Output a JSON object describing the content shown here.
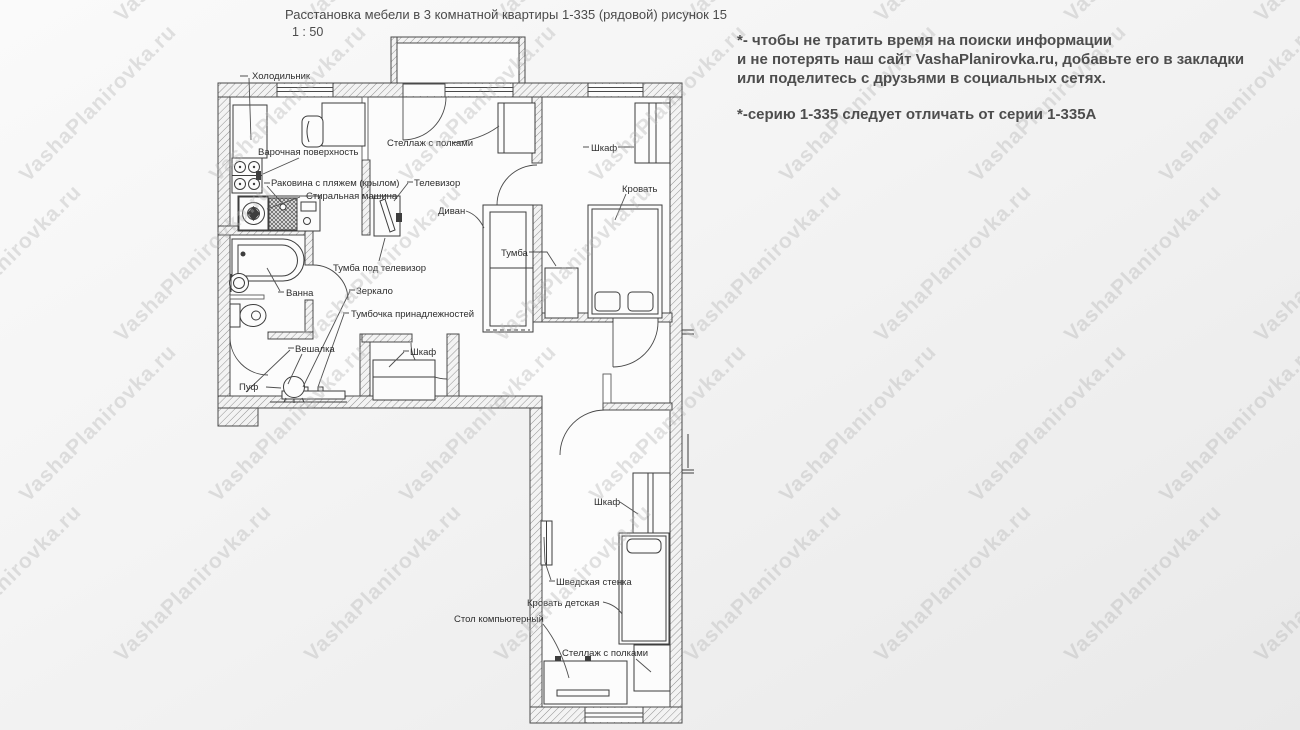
{
  "header": {
    "title": "Расстановка мебели в 3 комнатной квартиры 1-335 (рядовой) рисунок 15",
    "scale": "1 : 50"
  },
  "notes": {
    "line1": "*- чтобы не тратить время на поиски информации",
    "line2": " и не потерять наш сайт VashaPlanirovka.ru, добавьте его в закладки",
    "line3": "или поделитесь с друзьями в социальных сетях.",
    "line4": "*-серию 1-335 следует отличать от серии 1-335А"
  },
  "watermark": {
    "text": "VashaPlanirovka.ru"
  },
  "plan": {
    "labels": {
      "fridge": "Холодильник",
      "cooktop": "Варочная поверхность",
      "sink": "Раковина с пляжем (крылом)",
      "washer": "Стиральная машина",
      "shelving_living": "Стеллаж с полками",
      "tv": "Телевизор",
      "sofa": "Диван",
      "wardrobe_bedroom": "Шкаф",
      "bed": "Кровать",
      "tv_stand": "Тумба под телевизор",
      "nightstand": "Тумба",
      "bath": "Ванна",
      "mirror": "Зеркало",
      "accessory_stand": "Тумбочка принадлежностей",
      "coat_rack": "Вешалка",
      "pouf": "Пуф",
      "wardrobe_hall": "Шкаф",
      "wardrobe_kids": "Шкаф",
      "wall_bars": "Шведская стенка",
      "bed_kids": "Кровать детская",
      "computer_desk": "Стол компьютерный",
      "shelving_kids": "Стеллаж с полками"
    }
  }
}
